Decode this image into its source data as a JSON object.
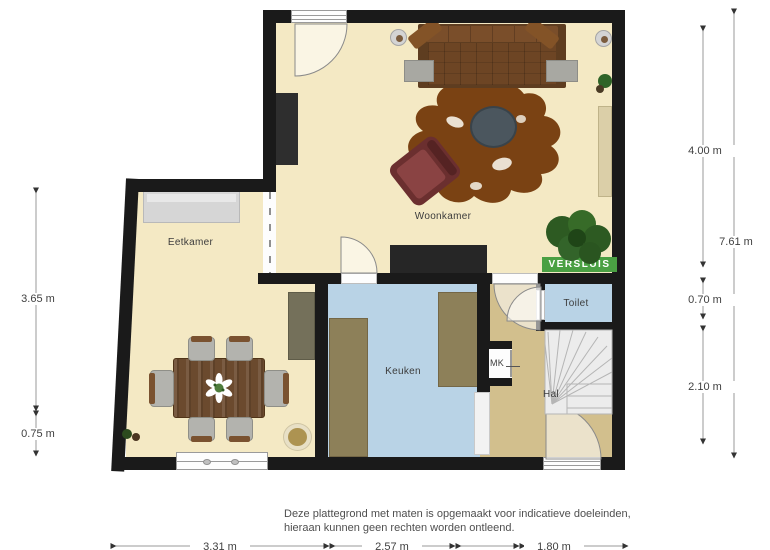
{
  "plan": {
    "watermark": "VERSLUIS",
    "rooms": {
      "woonkamer": "Woonkamer",
      "eetkamer": "Eetkamer",
      "keuken": "Keuken",
      "toilet": "Toilet",
      "hal": "Hal",
      "mk": "MK"
    },
    "dimensions": {
      "left_upper": "3.65 m",
      "left_lower": "0.75 m",
      "right_upper": "4.00 m",
      "right_middle": "0.70 m",
      "right_lower": "2.10 m",
      "right_total": "7.61 m",
      "bottom_left": "3.31 m",
      "bottom_middle": "2.57 m",
      "bottom_right": "1.80 m"
    },
    "disclaimer_line1": "Deze plattegrond met maten is opgemaakt voor indicatieve doeleinden,",
    "disclaimer_line2": "hieraan kunnen geen rechten worden ontleend.",
    "colors": {
      "wall": "#1a1a1a",
      "floor_living": "#f4e9c4",
      "floor_kitchen": "#b9d3e6",
      "floor_hall": "#d2bf8d",
      "watermark_green": "#4aa043"
    }
  }
}
